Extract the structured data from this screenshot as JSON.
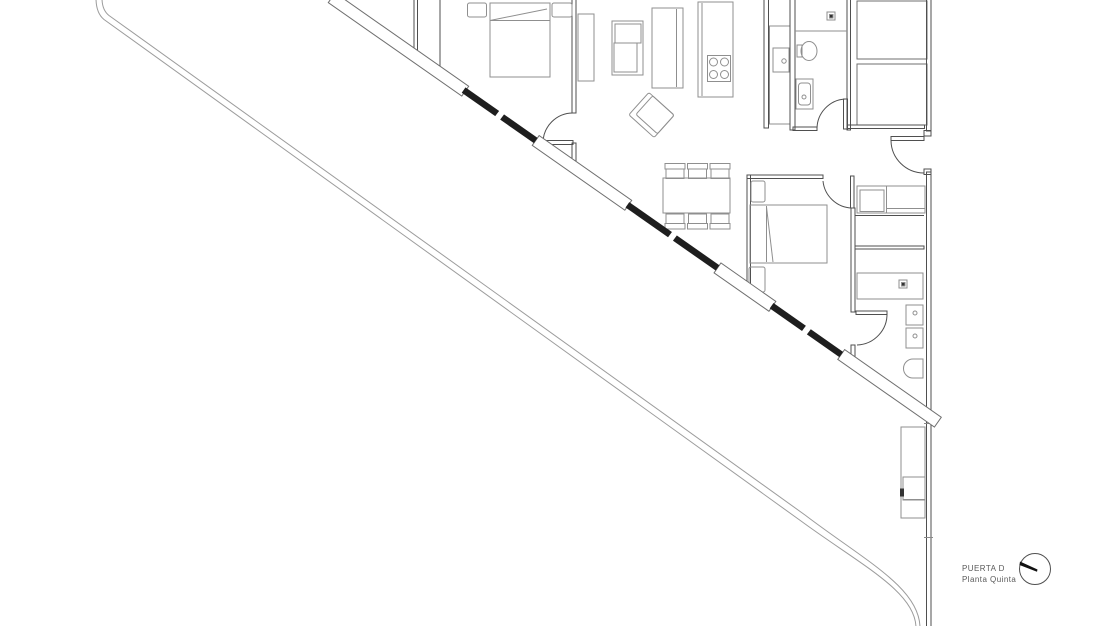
{
  "title_block": {
    "door": "PUERTA D",
    "floor": "Planta Quinta"
  },
  "north_indicator": {
    "icon": "compass-north-arrow-icon"
  },
  "colors": {
    "background": "#ffffff",
    "wall_line": "#4f4f4f",
    "furniture_line": "#8f8f8f",
    "railing_line": "#9c9c9c",
    "glazing": "#1e1e1e",
    "label_text": "#5a5a5a"
  },
  "plan": {
    "type": "apartment-floor-plan",
    "rooms": [
      "bedroom-1",
      "living-dining",
      "kitchen",
      "entrance-hall",
      "bathroom-1",
      "bedroom-2",
      "ensuite-bathroom-2",
      "terrace"
    ],
    "fixtures": [
      "double-bed-1",
      "nightstands",
      "wardrobe",
      "desk-unit",
      "tall-cabinet",
      "kitchen-island-cooktop",
      "kitchen-counter-sink",
      "shower-1",
      "toilet-1",
      "washbasin-1",
      "dining-table-6-chairs",
      "armchair",
      "double-bed-2",
      "hall-closet",
      "shower-2",
      "double-washbasin-2",
      "toilet-2",
      "utility-unit",
      "core-shafts"
    ]
  }
}
